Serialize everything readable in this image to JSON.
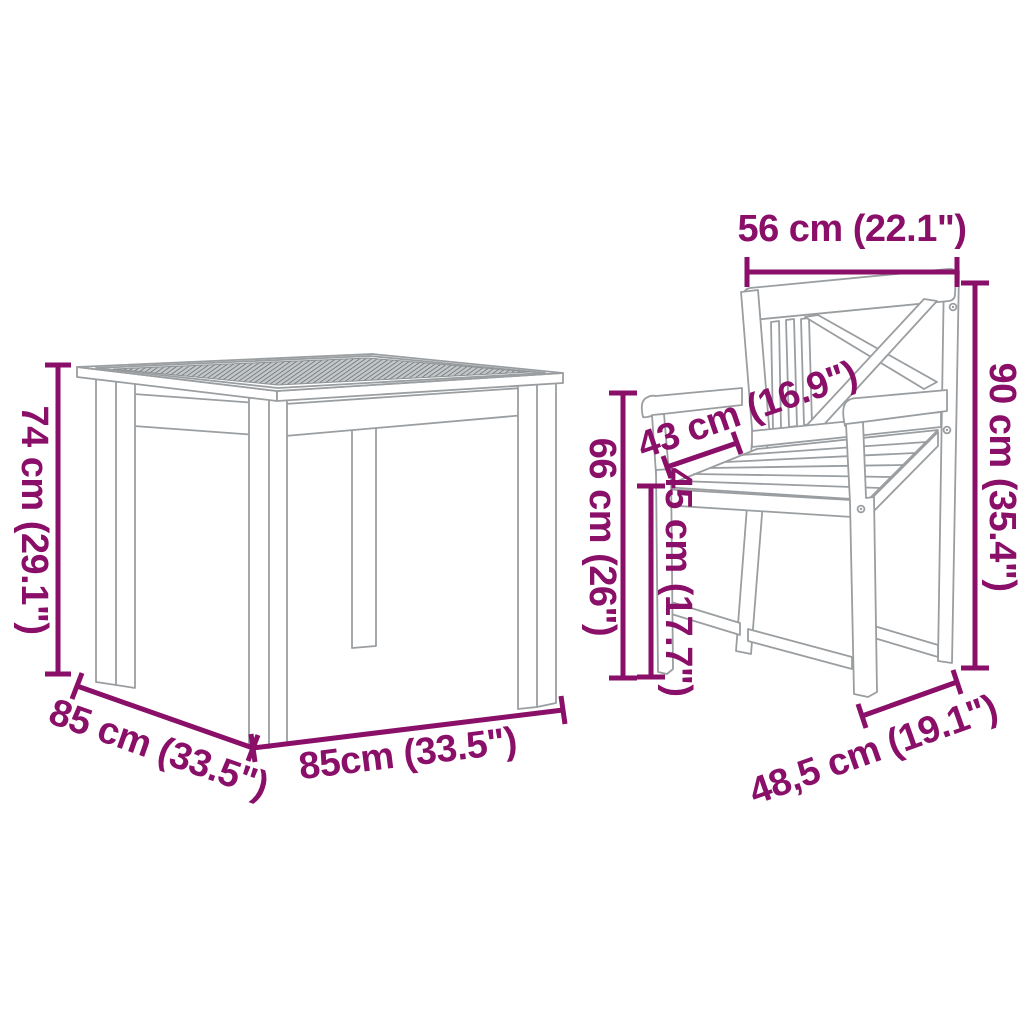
{
  "diagram": {
    "type": "furniture-dimension-diagram",
    "items": [
      "dining table",
      "armchair"
    ],
    "table": {
      "height": "74 cm (29.1\")",
      "depth": "85 cm (33.5\")",
      "width": "85cm (33.5\")"
    },
    "chair": {
      "backrest_width": "56 cm (22.1\")",
      "height": "90 cm (35.4\")",
      "armrest_depth": "43 cm (16.9\")",
      "armrest_height": "66 cm (26\")",
      "seat_height": "45 cm (17.7\")",
      "front_width": "48,5 cm (19.1\")"
    },
    "colors": {
      "dimension_color": "#8A0F68",
      "outline_color": "#9A9EA1",
      "tabletop_hatch_color": "#595E61",
      "background": "#FFFFFF"
    }
  }
}
